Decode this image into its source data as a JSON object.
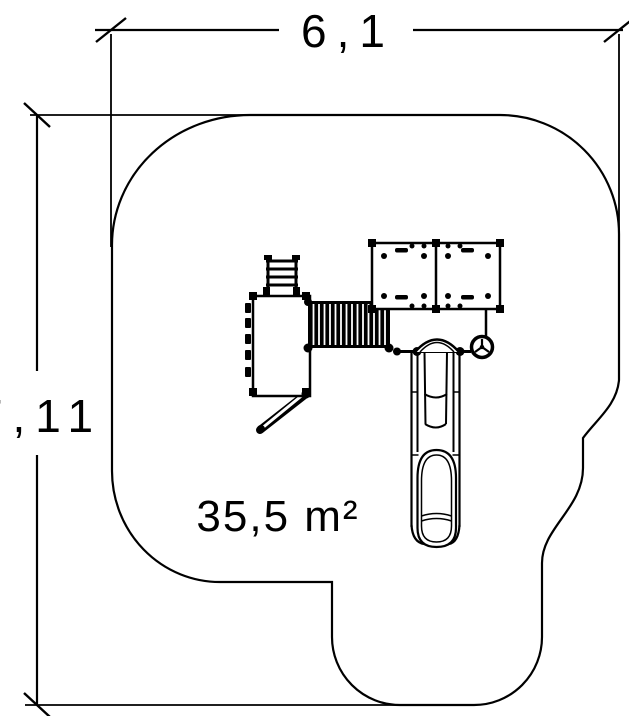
{
  "dimensions": {
    "width": {
      "label": "6,1"
    },
    "height": {
      "label": "7,11"
    }
  },
  "area": {
    "label": "35,5 m²"
  },
  "colors": {
    "line": "#000000",
    "background": "#ffffff"
  }
}
